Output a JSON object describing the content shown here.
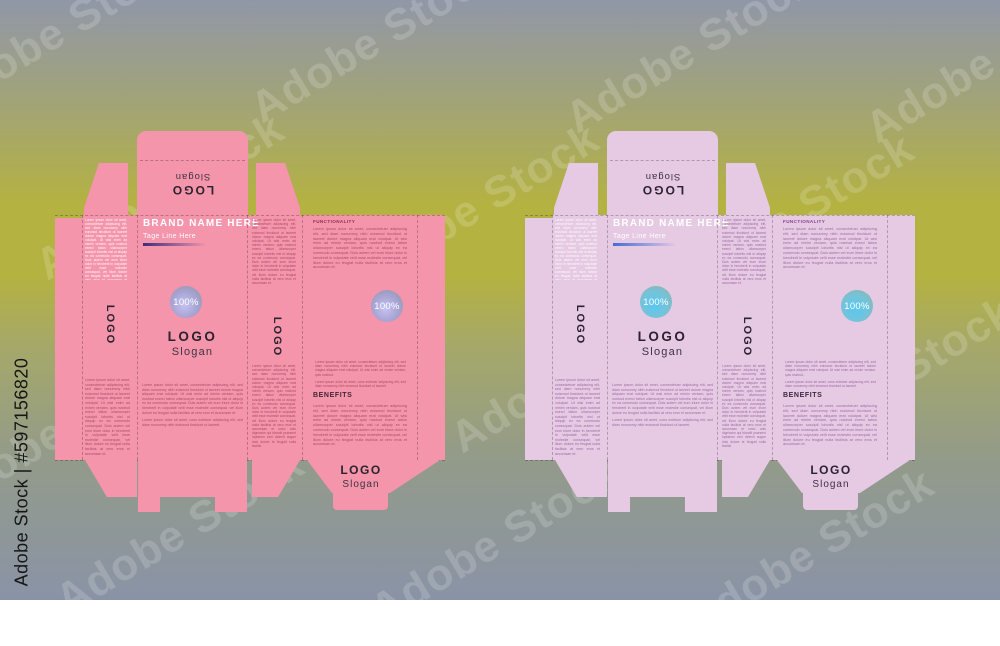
{
  "watermark": {
    "diagonal": "Adobe Stock",
    "side": "Adobe Stock | #597156820"
  },
  "labels": {
    "brand": "BRAND NAME HERE",
    "tagline": "Tage Line Here",
    "functionality": "FUNCTIONALITY",
    "benefits": "BENEFITS",
    "logo": "LOGO",
    "slogan": "Slogan",
    "percent": "100%"
  },
  "lorem": {
    "long": "Lorem ipsum dolor sit amet, consectetuer adipiscing elit, sed diam nonummy nibh euismod tincidunt ut laoreet dolore magna aliquam erat volutpat. Ut wisi enim ad minim veniam, quis nostrud exerci tation ullamcorper suscipit lobortis nisl ut aliquip ex ea commodo consequat. Duis autem vel eum iriure dolor in hendrerit in vulputate velit esse molestie consequat, vel illum dolore eu feugiat nulla facilisis at vero eros et accumsan et iusto odio dignissim qui blandit praesent luptatum zzril delenit augue duis dolore te feugait nulla facilisi.",
    "body": "Lorem ipsum dolor sit amet, consectetuer adipiscing elit, sed diam nonummy nibh euismod tincidunt ut laoreet dolore magna aliquam erat volutpat. Ut wisi enim ad minim veniam, quis nostrud exerci tation ullamcorper suscipit lobortis nisl ut aliquip ex ea commodo consequat. Duis autem vel eum iriure dolor in hendrerit in vulputate velit esse molestie consequat, vel illum dolore eu feugiat nulla facilisis at vero eros et accumsan et.",
    "short": "Lorem ipsum dolor sit amet, consectetuer adipiscing elit, sed diam nonummy nibh euismod tincidunt ut laoreet dolore magna aliquam erat volutpat. Ut wisi enim ad minim veniam, quis nostrud.",
    "mini": "Lorem ipsum dolor sit amet, cons ectetuer adipiscing elit, sed diam nonummy nibh euismod tincidunt ut laoreet."
  },
  "background": {
    "top": "#9097a8",
    "upper": "#a4a572",
    "band": "#b4b241",
    "mid": "#a5a86a",
    "lower": "#939b89",
    "bottom": "#8a93a6"
  },
  "boxes": [
    {
      "name": "pink box dieline",
      "colors": {
        "panel": "#f495ab",
        "ink": "#a84f67",
        "head": "#90314e",
        "dark": "#2a222e",
        "slogan": "#3c3442",
        "benefits": "#402633",
        "line": "#3b2f7e",
        "c-in": "#c6c3f2",
        "c-mid": "#a7a4d4",
        "c-out": "#94919d"
      }
    },
    {
      "name": "lavender box dieline",
      "colors": {
        "panel": "#e6c9e2",
        "ink": "#9c6ba6",
        "head": "#86438f",
        "dark": "#2a2230",
        "slogan": "#3c3343",
        "benefits": "#3a2742",
        "line": "#3f6fd6",
        "c-in": "#58c8f2",
        "c-mid": "#74c3da",
        "c-out": "#95b1a2"
      }
    }
  ]
}
